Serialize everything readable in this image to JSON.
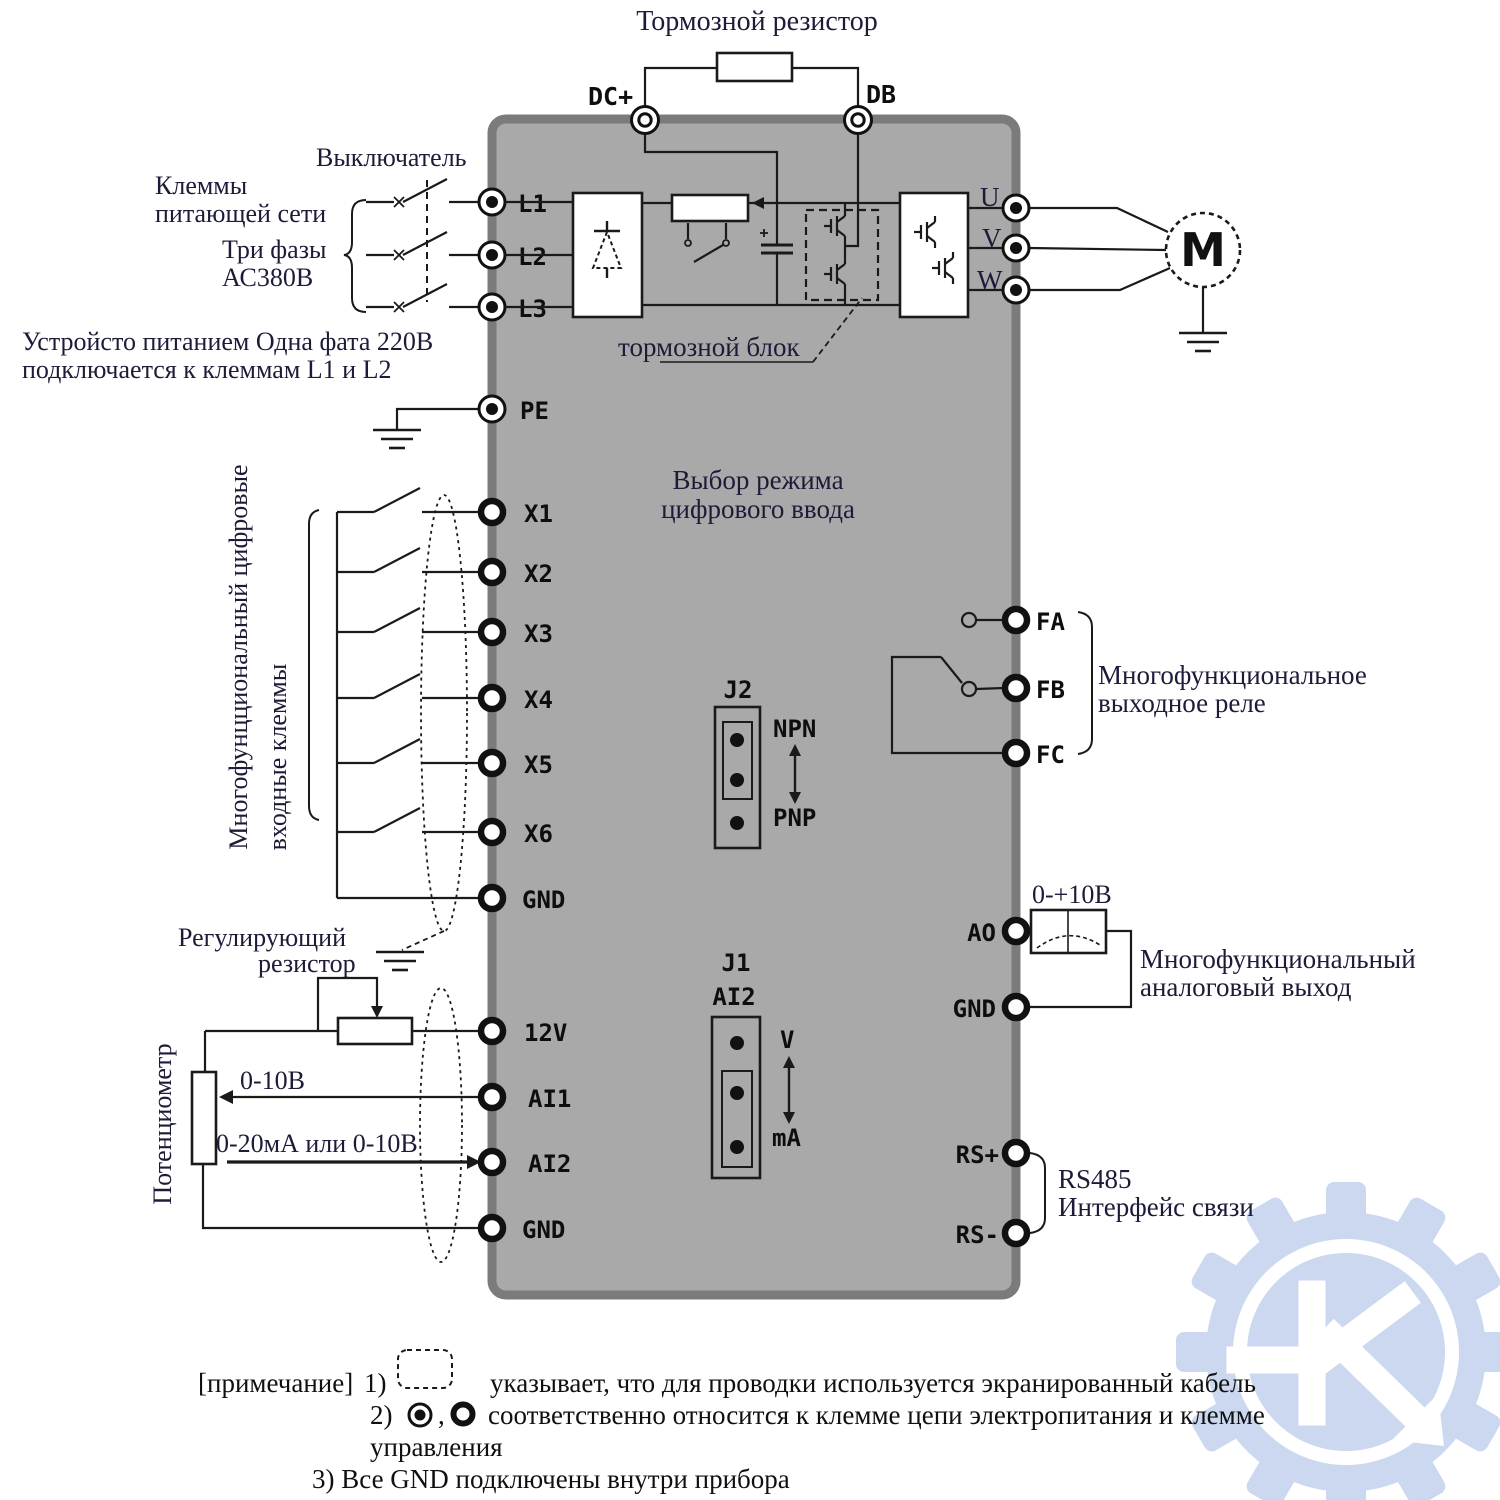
{
  "title": "Тормозной резистор",
  "terminals": {
    "dc_plus": "DC+",
    "db": "DB",
    "l1": "L1",
    "l2": "L2",
    "l3": "L3",
    "pe": "PE",
    "x1": "X1",
    "x2": "X2",
    "x3": "X3",
    "x4": "X4",
    "x5": "X5",
    "x6": "X6",
    "gnd_digital": "GND",
    "v12": "12V",
    "ai1": "AI1",
    "ai2": "AI2",
    "gnd_analog": "GND",
    "u": "U",
    "v": "V",
    "w": "W",
    "motor": "M",
    "fa": "FA",
    "fb": "FB",
    "fc": "FC",
    "ao": "AO",
    "gnd_ao": "GND",
    "rs_plus": "RS+",
    "rs_minus": "RS-"
  },
  "labels": {
    "breaker": "Выключатель",
    "supply_terminals_1": "Клеммы",
    "supply_terminals_2": "питающей сети",
    "three_phase_1": "Три фазы",
    "three_phase_2": "АС380В",
    "single_phase_1": "Устройсто питанием Одна фата 220В",
    "single_phase_2": "подключается к клеммам L1 и L2",
    "brake_unit": "тормозной блок",
    "digital_inputs_1": "Многофунцциональный цифровые",
    "digital_inputs_2": "входные клеммы",
    "digital_mode_1": "Выбор режима",
    "digital_mode_2": "цифрового ввода",
    "adjusting_resistor_1": "Регулирующий",
    "adjusting_resistor_2": "резистор",
    "potentiometer": "Потенциометр",
    "range_ai1": "0-10В",
    "range_ai2": "0-20мА или 0-10В",
    "relay_output_1": "Многофункциональное",
    "relay_output_2": "выходное реле",
    "analog_range": "0-+10В",
    "analog_output_1": "Многофункциональный",
    "analog_output_2": "аналоговый выход",
    "rs485_1": "RS485",
    "rs485_2": "Интерфейс связи"
  },
  "jumpers": {
    "j2": {
      "name": "J2",
      "top": "NPN",
      "bottom": "PNP"
    },
    "j1": {
      "name": "J1",
      "sub": "AI2",
      "top": "V",
      "bottom": "mA"
    }
  },
  "notes": {
    "prefix": "[примечание]",
    "n1_num": "1)",
    "n1": "указывает, что для проводки используется экранированный кабель",
    "n2_num": "2)",
    "comma": ",",
    "n2a": "соответственно относится к клемме цепи электропитания и клемме",
    "n2b": "управления",
    "n3": "3) Все GND подключены внутри прибора"
  },
  "colors": {
    "body": "#a9a9a9",
    "border": "#7b7b7b",
    "ink": "#1a1a1a",
    "label_text": "#1c1c38",
    "watermark": "#cbd8f0"
  }
}
